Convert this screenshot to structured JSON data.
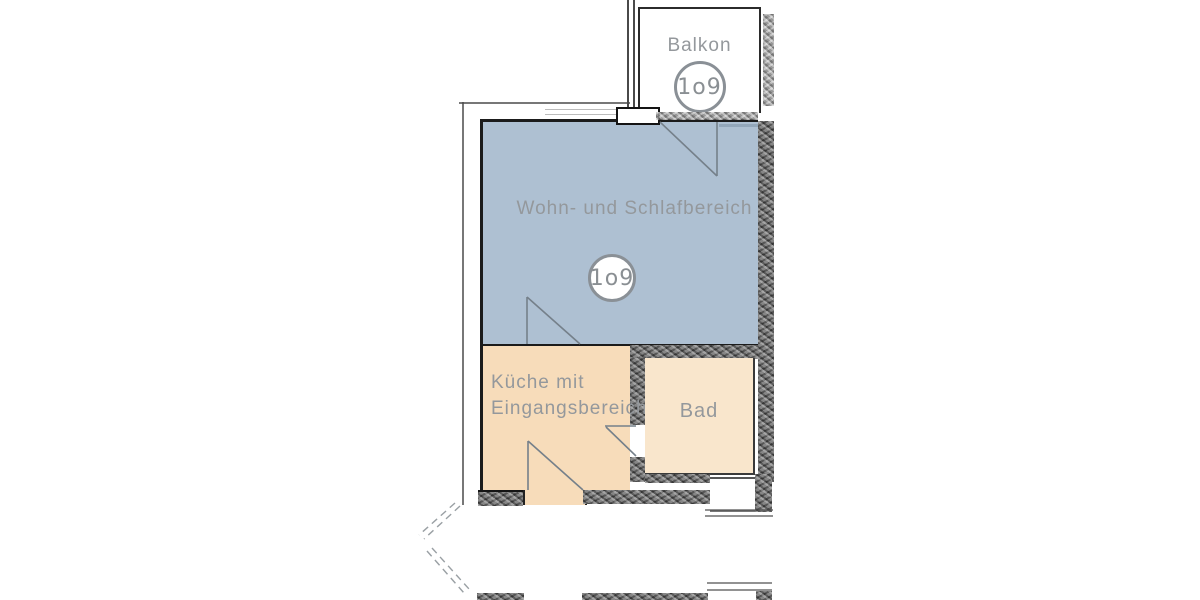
{
  "rooms": {
    "balcony": {
      "label": "Balkon",
      "badge": "1o9"
    },
    "living": {
      "label": "Wohn- und Schlafbereich",
      "badge": "1o9",
      "color": "#aec0d2"
    },
    "kitchen": {
      "label_line1": "Küche mit",
      "label_line2": "Eingangsbereich",
      "color": "#f7dcba"
    },
    "bath": {
      "label": "Bad",
      "color": "#f9e6cc"
    }
  },
  "colors": {
    "wall": "#5f5f5f",
    "outline": "#1b1b1b",
    "label_text": "#94989c",
    "badge_border": "#8a9096",
    "swing_line": "#75808a",
    "slab_edge": "#93a7ba"
  }
}
